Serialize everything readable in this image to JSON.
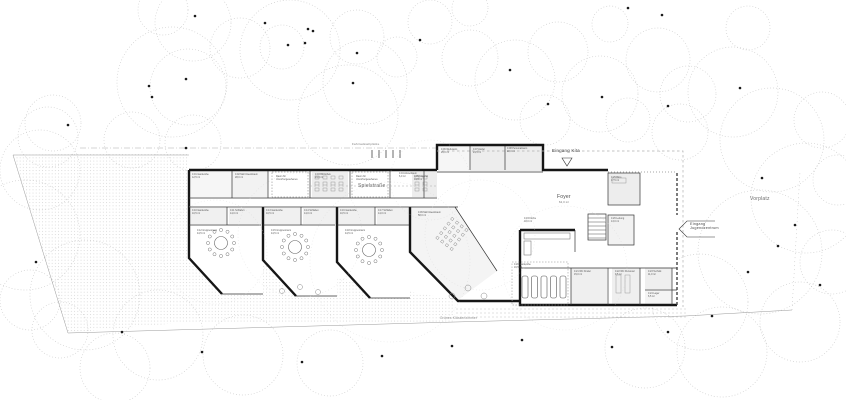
{
  "labels": {
    "eingang_kita": "Eingang Kita",
    "spielstrasse": "Spielstraße",
    "foyer": "Foyer",
    "foyer_area": "62,0 m²",
    "vorplatz": "Vorplatz",
    "eingang_jugendzentrum_l1": "Eingang",
    "eingang_jugendzentrum_l2": "Jugendzentrum",
    "gruenes_klassenzimmer": "Grünes Klassenzimmer",
    "fahrradstellplaetze": "Fahrradstellplätze"
  },
  "rooms": [
    {
      "x": 192,
      "y": 174,
      "l1": "0.01 Garderobe",
      "l2": "12,5 m²"
    },
    {
      "x": 235,
      "y": 174,
      "l1": "0.02 Mehrzweckraum",
      "l2": "28,0 m²"
    },
    {
      "x": 276,
      "y": 176,
      "l1": "Raum für",
      "l2": "Unvorhergesehenes"
    },
    {
      "x": 315,
      "y": 174,
      "l1": "0.03 Bibliothek",
      "l2": "24,0 m²"
    },
    {
      "x": 356,
      "y": 176,
      "l1": "Raum für",
      "l2": "Unvorhergesehenes"
    },
    {
      "x": 399,
      "y": 173,
      "l1": "0.04 Abstellraum",
      "l2": "6,0 m²"
    },
    {
      "x": 414,
      "y": 176,
      "l1": "0.05 Material",
      "l2": "14,5 m²"
    },
    {
      "x": 441,
      "y": 149,
      "l1": "0.06 Werkraum",
      "l2": "26,0 m²"
    },
    {
      "x": 473,
      "y": 149,
      "l1": "0.07 Atelier",
      "l2": "24,5 m²"
    },
    {
      "x": 507,
      "y": 148,
      "l1": "0.08 Personalraum",
      "l2": "22,0 m²"
    },
    {
      "x": 418,
      "y": 212,
      "l1": "0.09 Mehrzweckraum",
      "l2": "58,0 m²"
    },
    {
      "x": 192,
      "y": 210,
      "l1": "0.10 Garderobe",
      "l2": "10,5 m²"
    },
    {
      "x": 230,
      "y": 210,
      "l1": "0.11 Schlafen",
      "l2": "14,0 m²"
    },
    {
      "x": 197,
      "y": 230,
      "l1": "0.12 Gruppenraum",
      "l2": "44,5 m²"
    },
    {
      "x": 266,
      "y": 210,
      "l1": "0.13 Garderobe",
      "l2": "10,5 m²"
    },
    {
      "x": 304,
      "y": 210,
      "l1": "0.14 Schlafen",
      "l2": "14,0 m²"
    },
    {
      "x": 271,
      "y": 230,
      "l1": "0.15 Gruppenraum",
      "l2": "44,5 m²"
    },
    {
      "x": 340,
      "y": 210,
      "l1": "0.16 Garderobe",
      "l2": "10,5 m²"
    },
    {
      "x": 378,
      "y": 210,
      "l1": "0.17 Schlafen",
      "l2": "14,0 m²"
    },
    {
      "x": 345,
      "y": 230,
      "l1": "0.18 Gruppenraum",
      "l2": "44,5 m²"
    },
    {
      "x": 524,
      "y": 218,
      "l1": "0.19 Küche",
      "l2": "18,0 m²"
    },
    {
      "x": 514,
      "y": 264,
      "l1": "0.20 Garderobe",
      "l2": "16,5 m²"
    },
    {
      "x": 574,
      "y": 271,
      "l1": "0.21 WC Kinder",
      "l2": "15,0 m²"
    },
    {
      "x": 615,
      "y": 271,
      "l1": "0.22 WC Personal",
      "l2": "9,5 m²"
    },
    {
      "x": 648,
      "y": 271,
      "l1": "0.23 Technik",
      "l2": "11,0 m²"
    },
    {
      "x": 648,
      "y": 293,
      "l1": "0.24 Lager",
      "l2": "6,5 m²"
    },
    {
      "x": 611,
      "y": 177,
      "l1": "0.25 Büro",
      "l2": "17,5 m²"
    },
    {
      "x": 611,
      "y": 218,
      "l1": "0.26 Leitung",
      "l2": "13,0 m²"
    }
  ],
  "colors": {
    "wall": "#161616",
    "thin_line": "#333333",
    "tree_outline": "#c6c6c6",
    "stipple": "#c9c9c9",
    "room_fill": "#ededed",
    "boundary": "#999999",
    "text": "#4a4a4a"
  }
}
